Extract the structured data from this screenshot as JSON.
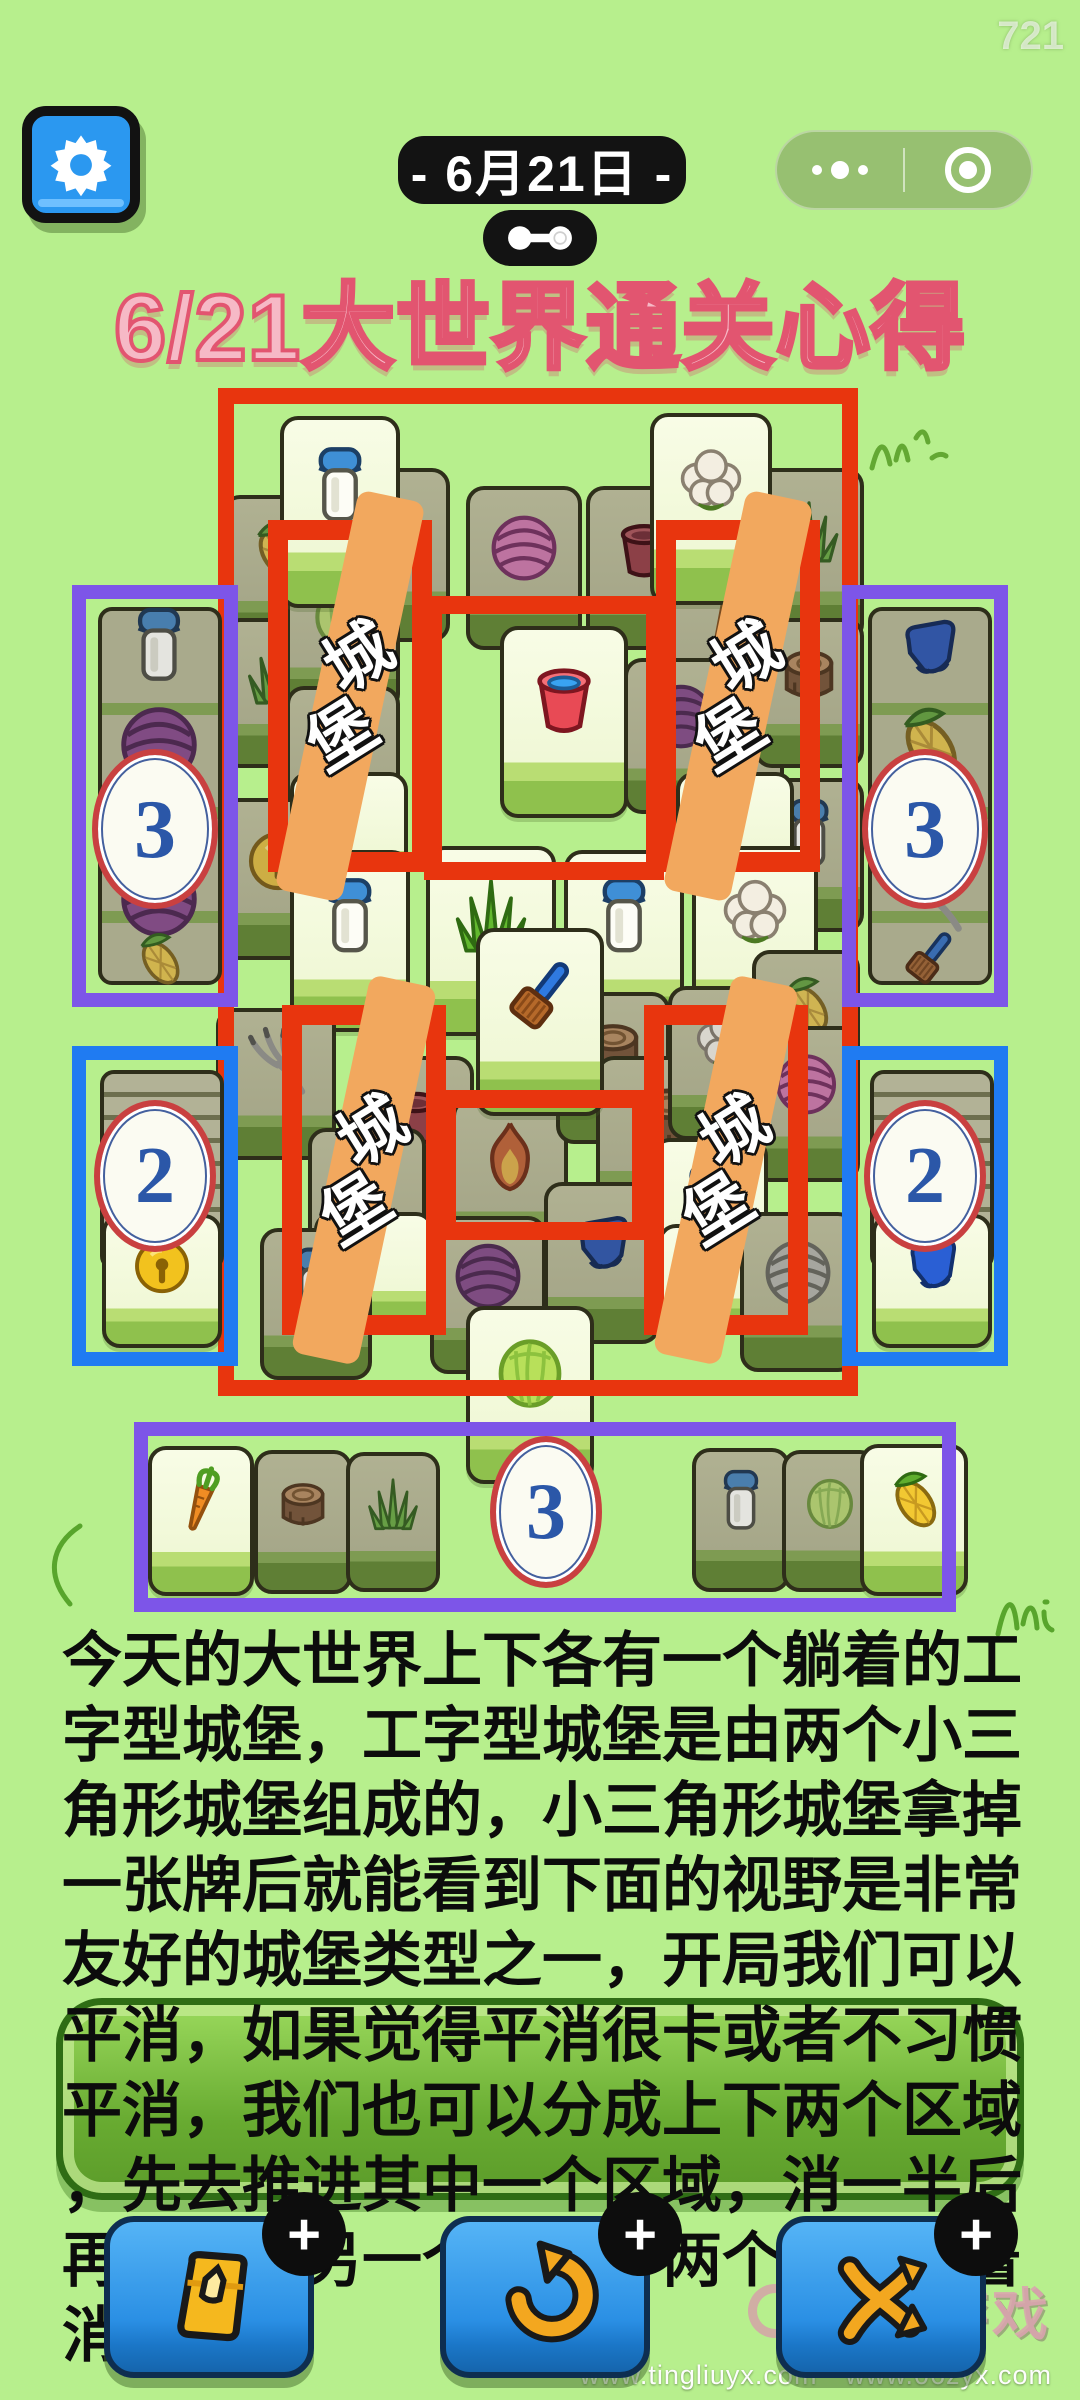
{
  "status": {
    "time": "721"
  },
  "header": {
    "date_label": "- 6月21日 -",
    "settings_icon": "gear-icon",
    "capsule": {
      "more_icon": "more-dots-icon",
      "home_icon": "target-icon"
    },
    "link_icon": "dumbbell-icon"
  },
  "title": "6/21大世界通关心得",
  "colors": {
    "bg": "#b7ef8d",
    "red": "#e8350e",
    "purple": "#7d55e8",
    "blue": "#1f7bf2",
    "ribbon": "#f2a85e",
    "titleFill": "#f6b9c6",
    "titleStroke": "#e25570",
    "btnBlue": "#2e96ea",
    "iconYellow": "#f3a71f",
    "numBlue": "#2b57a8"
  },
  "board": {
    "castle_label": "城堡",
    "frame": {
      "x": 218,
      "y": 388,
      "w": 640,
      "h": 1008
    },
    "tiles": [
      {
        "icon": "corn",
        "x": 222,
        "y": 495,
        "w": 112,
        "h": 150
      },
      {
        "icon": "grass",
        "x": 338,
        "y": 468,
        "w": 112,
        "h": 174
      },
      {
        "icon": "yarn-pink",
        "x": 466,
        "y": 486,
        "w": 116,
        "h": 164
      },
      {
        "icon": "pot",
        "x": 586,
        "y": 486,
        "w": 116,
        "h": 164
      },
      {
        "icon": "grass",
        "x": 754,
        "y": 468,
        "w": 110,
        "h": 174
      },
      {
        "icon": "grass",
        "x": 222,
        "y": 618,
        "w": 112,
        "h": 150
      },
      {
        "icon": "cabbage",
        "x": 286,
        "y": 560,
        "w": 114,
        "h": 152
      },
      {
        "icon": "carrot",
        "x": 286,
        "y": 686,
        "w": 114,
        "h": 152
      },
      {
        "icon": "carrot",
        "x": 670,
        "y": 560,
        "w": 114,
        "h": 152
      },
      {
        "icon": "corn",
        "x": 670,
        "y": 686,
        "w": 114,
        "h": 152
      },
      {
        "icon": "yarn-purple",
        "x": 624,
        "y": 658,
        "w": 114,
        "h": 156
      },
      {
        "icon": "stump",
        "x": 754,
        "y": 618,
        "w": 110,
        "h": 150
      },
      {
        "icon": "bell",
        "x": 220,
        "y": 798,
        "w": 116,
        "h": 162
      },
      {
        "icon": "milk",
        "x": 754,
        "y": 778,
        "w": 110,
        "h": 154
      },
      {
        "icon": "milk",
        "x": 280,
        "y": 416,
        "w": 120,
        "h": 192,
        "bright": true
      },
      {
        "icon": "cauliflower",
        "x": 650,
        "y": 413,
        "w": 122,
        "h": 192,
        "bright": true
      },
      {
        "icon": "empty",
        "x": 290,
        "y": 772,
        "w": 118,
        "h": 112,
        "bright": true
      },
      {
        "icon": "empty",
        "x": 676,
        "y": 772,
        "w": 118,
        "h": 112,
        "bright": true
      },
      {
        "icon": "bucket",
        "x": 500,
        "y": 626,
        "w": 128,
        "h": 192,
        "bright": true
      },
      {
        "icon": "milk",
        "x": 290,
        "y": 850,
        "w": 120,
        "h": 182,
        "bright": true
      },
      {
        "icon": "grass",
        "x": 426,
        "y": 846,
        "w": 130,
        "h": 190,
        "bright": true
      },
      {
        "icon": "milk",
        "x": 564,
        "y": 850,
        "w": 120,
        "h": 182,
        "bright": true
      },
      {
        "icon": "cauliflower",
        "x": 692,
        "y": 846,
        "w": 126,
        "h": 188,
        "bright": true
      },
      {
        "icon": "fork",
        "x": 216,
        "y": 1008,
        "w": 120,
        "h": 152
      },
      {
        "icon": "pot",
        "x": 356,
        "y": 1056,
        "w": 118,
        "h": 158
      },
      {
        "icon": "fire",
        "x": 452,
        "y": 1098,
        "w": 116,
        "h": 160
      },
      {
        "icon": "stump",
        "x": 556,
        "y": 992,
        "w": 114,
        "h": 152
      },
      {
        "icon": "stump",
        "x": 596,
        "y": 1056,
        "w": 146,
        "h": 162
      },
      {
        "icon": "cauliflower",
        "x": 668,
        "y": 986,
        "w": 114,
        "h": 154
      },
      {
        "icon": "corn",
        "x": 752,
        "y": 950,
        "w": 108,
        "h": 150
      },
      {
        "icon": "yarn-pink",
        "x": 752,
        "y": 1026,
        "w": 108,
        "h": 156
      },
      {
        "icon": "brush",
        "x": 476,
        "y": 928,
        "w": 128,
        "h": 188,
        "bright": true
      },
      {
        "icon": "carrot",
        "x": 308,
        "y": 1128,
        "w": 118,
        "h": 162
      },
      {
        "icon": "milk",
        "x": 652,
        "y": 1138,
        "w": 116,
        "h": 172,
        "bright": true
      },
      {
        "icon": "empty",
        "x": 314,
        "y": 1212,
        "w": 120,
        "h": 112,
        "bright": true
      },
      {
        "icon": "empty",
        "x": 658,
        "y": 1224,
        "w": 118,
        "h": 106,
        "bright": true
      },
      {
        "icon": "milk",
        "x": 260,
        "y": 1228,
        "w": 112,
        "h": 152
      },
      {
        "icon": "yarn-purple",
        "x": 430,
        "y": 1216,
        "w": 116,
        "h": 158
      },
      {
        "icon": "glove",
        "x": 544,
        "y": 1182,
        "w": 116,
        "h": 162
      },
      {
        "icon": "yarn-gray",
        "x": 740,
        "y": 1212,
        "w": 116,
        "h": 160
      },
      {
        "icon": "cabbage",
        "x": 466,
        "y": 1306,
        "w": 128,
        "h": 178,
        "bright": true
      }
    ],
    "castles": [
      {
        "x": 268,
        "y": 520,
        "w": 164,
        "h": 352
      },
      {
        "x": 656,
        "y": 520,
        "w": 164,
        "h": 352
      },
      {
        "x": 282,
        "y": 1005,
        "w": 164,
        "h": 330
      },
      {
        "x": 644,
        "y": 1005,
        "w": 164,
        "h": 330
      }
    ],
    "connectors": [
      {
        "x": 424,
        "y": 596,
        "w": 240,
        "h": 284
      },
      {
        "x": 438,
        "y": 1090,
        "w": 212,
        "h": 150
      }
    ],
    "side_boxes": [
      {
        "type": "purple",
        "x": 72,
        "y": 585,
        "w": 166,
        "h": 422,
        "number": "3",
        "icons_above": [
          "milk",
          "yarn-purple"
        ],
        "icons_below": [
          "yarn-purple",
          "corn"
        ]
      },
      {
        "type": "purple",
        "x": 842,
        "y": 585,
        "w": 166,
        "h": 422,
        "number": "3",
        "icons_above": [
          "glove",
          "corn"
        ],
        "icons_below": [
          "fork",
          "brush"
        ]
      },
      {
        "type": "blue",
        "x": 72,
        "y": 1046,
        "w": 166,
        "h": 320,
        "number": "2",
        "item": "bell"
      },
      {
        "type": "blue",
        "x": 842,
        "y": 1046,
        "w": 166,
        "h": 320,
        "number": "2",
        "item": "glove"
      }
    ]
  },
  "bottom_strip": {
    "x": 134,
    "y": 1422,
    "w": 822,
    "h": 190,
    "number": "3",
    "tiles": [
      {
        "icon": "carrot",
        "x": 148,
        "y": 1446,
        "w": 106,
        "h": 150,
        "bright": true
      },
      {
        "icon": "stump",
        "x": 254,
        "y": 1450,
        "w": 98,
        "h": 144
      },
      {
        "icon": "grass",
        "x": 346,
        "y": 1452,
        "w": 94,
        "h": 140
      },
      {
        "icon": "milk",
        "x": 692,
        "y": 1448,
        "w": 98,
        "h": 144
      },
      {
        "icon": "cabbage",
        "x": 782,
        "y": 1450,
        "w": 96,
        "h": 142
      },
      {
        "icon": "corn",
        "x": 860,
        "y": 1444,
        "w": 108,
        "h": 152,
        "bright": true
      }
    ]
  },
  "paragraph": [
    "今天的大世界上下各有一个躺着的工",
    "字型城堡，工字型城堡是由两个小三",
    "角形城堡组成的，小三角形城堡拿掉",
    "一张牌后就能看到下面的视野是非常",
    "友好的城堡类型之一，开局我们可以",
    "平消，如果觉得平消很卡或者不习惯",
    "平消，我们也可以分成上下两个区域",
    "，先去推进其中一个区域，消一半后",
    "再去推进另一个区域，两个区域换着",
    "消"
  ],
  "toolbar": {
    "buttons": [
      {
        "name": "remove-tool-button",
        "icon": "bag-icon",
        "badge": "+"
      },
      {
        "name": "undo-button",
        "icon": "undo-icon",
        "badge": "+"
      },
      {
        "name": "shuffle-button",
        "icon": "shuffle-icon",
        "badge": "+"
      }
    ]
  },
  "watermark": {
    "brand": "零元游戏",
    "urls": "www.tingliuyx.com　www.06zyx.com"
  }
}
